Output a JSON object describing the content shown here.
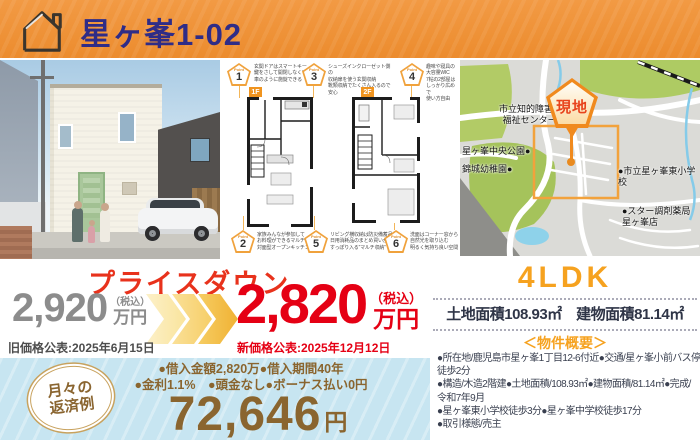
{
  "colors": {
    "header_orange": "#EC8C2E",
    "title_navy": "#2F2C87",
    "price_red": "#E50014",
    "accent_orange": "#F6A21F",
    "loan_brown": "#8A652F",
    "loan_bg_blue": "#C7E5F1"
  },
  "header": {
    "title": "星ヶ峯1-02"
  },
  "floorplan": {
    "f1_label": "1F",
    "f2_label": "2F",
    "points": [
      {
        "badge": "Point",
        "num": "1",
        "lines": [
          "玄関ドアはスマートキー",
          "鍵をさして開閉しなくても",
          "車のように施錠できる"
        ]
      },
      {
        "badge": "Point",
        "num": "3",
        "lines": [
          "シューズインクローゼット側の",
          "収納扉を使う玄関収納",
          "靴類収納でたくさん入るので安心"
        ]
      },
      {
        "badge": "Point",
        "num": "4",
        "lines": [
          "趣味や寝具の大容量WIC",
          "7帖の2部屋はしっかり広めで",
          "使い方自由"
        ]
      },
      {
        "badge": "Point",
        "num": "2",
        "lines": [
          "家族みんなが参加して",
          "お料理ができるマルチ収納",
          "対面型オープンキッチン"
        ]
      },
      {
        "badge": "Point",
        "num": "5",
        "lines": [
          "リビング横収納は防災備蓄品",
          "日用消耗品のまとめ買いが",
          "すっぽり入る“マルチ収納”"
        ]
      },
      {
        "badge": "Point",
        "num": "6",
        "lines": [
          "洗面はコーナー窓から",
          "自然光を取り込む",
          "明るく気持ち良い空間"
        ]
      }
    ]
  },
  "map": {
    "site_badge": "現地",
    "labels": {
      "welfare": "市立知的障害者\n福祉センター●",
      "park": "星ヶ峯中央公園●",
      "kindergarten": "錦城幼稚園●",
      "school": "●市立星ヶ峯東小学校",
      "pharmacy": "●スター調剤薬局\n星ヶ峯店"
    }
  },
  "price": {
    "campaign": "プライスダウン",
    "old": {
      "value": "2,920",
      "tax": "（税込）",
      "unit": "万円",
      "note": "旧価格公表:2025年6月15日"
    },
    "new": {
      "value": "2,820",
      "tax": "（税込）",
      "unit": "万円",
      "note": "新価格公表:2025年12月12日"
    }
  },
  "summary": {
    "layout": "4LDK",
    "areas": "土地面積108.93㎡　建物面積81.14㎡",
    "heading": "＜物件概要＞",
    "lines": [
      "●所在地/鹿児島市星ヶ峯1丁目12-6付近●交通/星ヶ峯小前バス停",
      "徒歩2分",
      "●構造/木造2階建●土地面積/108.93㎡●建物面積/81.14㎡●完成/",
      "令和7年9月",
      "●星ヶ峯東小学校徒歩3分●星ヶ峯中学校徒歩17分",
      "●取引様態/売主"
    ]
  },
  "loan": {
    "badge": [
      "月々の",
      "返済例"
    ],
    "terms1": "●借入金額2,820万●借入期間40年",
    "terms2": "●金利1.1%　●頭金なし●ボーナス払い0円",
    "amount": "72,646",
    "unit": "円"
  }
}
